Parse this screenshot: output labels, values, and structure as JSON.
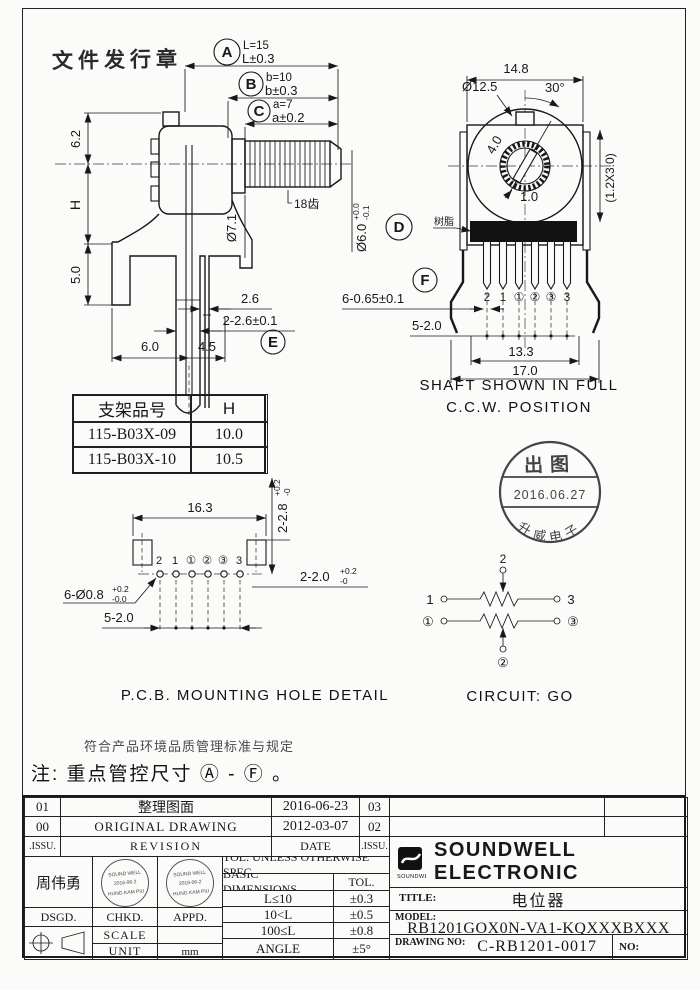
{
  "frame": {
    "doc_stamp": "文件发行章"
  },
  "callouts": {
    "a": {
      "letter": "A",
      "l1": "L=15",
      "l2": "L±0.3"
    },
    "b": {
      "letter": "B",
      "l1": "b=10",
      "l2": "b±0.3"
    },
    "c": {
      "letter": "C",
      "l1": "a=7",
      "l2": "a±0.2"
    },
    "d": {
      "letter": "D"
    },
    "e": {
      "letter": "E"
    },
    "f": {
      "letter": "F"
    }
  },
  "side_view": {
    "dim_top": "6.2",
    "dim_h": "H",
    "dim_5": "5.0",
    "dim_26": "2.6",
    "dim_2_26": "2-2.6±0.1",
    "dim_6": "6.0",
    "dim_45": "4.5",
    "dia_bushing": "Ø7.1",
    "teeth": "18齿",
    "dia_shaft": "Ø6.0",
    "dia_shaft_sup": "+0.0",
    "dia_shaft_sub": "-0.1"
  },
  "front_view": {
    "dim_width": "14.8",
    "dia_rotor": "Ø12.5",
    "angle": "30°",
    "dim_slot_len": "4.0",
    "dim_slot_w": "1.0",
    "dim_tab": "(1.2X3.0)",
    "resin_label": "树脂",
    "pins": [
      "2",
      "1",
      "①",
      "②",
      "③",
      "3"
    ],
    "dim_pin": "6-0.65±0.1",
    "dim_pitch": "5-2.0",
    "dim_133": "13.3",
    "dim_170": "17.0",
    "caption1": "SHAFT SHOWN IN FULL",
    "caption2": "C.C.W. POSITION"
  },
  "bracket_table": {
    "h_part": "支架品号",
    "h_h": "H",
    "rows": [
      {
        "part": "115-B03X-09",
        "h": "10.0"
      },
      {
        "part": "115-B03X-10",
        "h": "10.5"
      }
    ]
  },
  "pcb": {
    "dim_163": "16.3",
    "dim_28": "2-2.8",
    "dim_28_sup": "+0.2",
    "dim_28_sub": "-0",
    "dim_20": "2-2.0",
    "dim_20_sup": "+0.2",
    "dim_20_sub": "-0",
    "dim_hole": "6-Ø0.8",
    "dim_hole_sup": "+0.2",
    "dim_hole_sub": "-0.0",
    "dim_pitch": "5-2.0",
    "pins": [
      "2",
      "1",
      "①",
      "②",
      "③",
      "3"
    ],
    "caption": "P.C.B. MOUNTING HOLE DETAIL"
  },
  "stamp": {
    "top": "出图",
    "date": "2016.06.27",
    "bottom": "升威电子"
  },
  "circuit": {
    "t1": "1",
    "t2": "2",
    "t3": "3",
    "b1": "①",
    "b2": "②",
    "b3": "③",
    "caption": "CIRCUIT: GO"
  },
  "notes": {
    "line1": "符合产品环境品质管理标准与规定",
    "line2": "注: 重点管控尺寸 Ⓐ - Ⓕ 。"
  },
  "revision": {
    "h_issu": ".ISSU.",
    "h_desc": "REVISION",
    "h_date": "DATE",
    "h_num": ".ISSU.",
    "rows": [
      {
        "issu": "01",
        "desc": "整理图面",
        "date": "2016-06-23",
        "num": "03"
      },
      {
        "issu": "00",
        "desc": "ORIGINAL DRAWING",
        "date": "2012-03-07",
        "num": "02"
      }
    ]
  },
  "title_block": {
    "designer": "周伟勇",
    "dsgd": "DSGD.",
    "chkd": "CHKD.",
    "appd": "APPD.",
    "stamp_line1": "SOUND WELL",
    "stamp_line2": "2016-06-2",
    "stamp_line3": "HUNG KAM PIU",
    "scale_label": "SCALE",
    "unit_label": "UNIT",
    "unit_value": "mm",
    "tol_header": "TOL. UNLESS OTHERWISE SPEC.",
    "tol_c1": "BASIC DIMENSIONS",
    "tol_c2": "TOL.",
    "tol_rows": [
      {
        "range": "L≤10",
        "tol": "±0.3"
      },
      {
        "range": "10<L",
        "tol": "±0.5"
      },
      {
        "range": "100≤L",
        "tol": "±0.8"
      },
      {
        "range": "ANGLE",
        "tol": "±5°"
      }
    ],
    "logo_text": "SOUNDWELL",
    "company": "SOUNDWELL  ELECTRONIC",
    "title_label": "TITLE:",
    "title_value": "电位器",
    "model_label": "MODEL:",
    "model_value": "RB1201GOX0N-VA1-KQXXXBXXX",
    "drawing_label": "DRAWING NO:",
    "drawing_value": "C-RB1201-0017",
    "no_label": "NO:"
  }
}
